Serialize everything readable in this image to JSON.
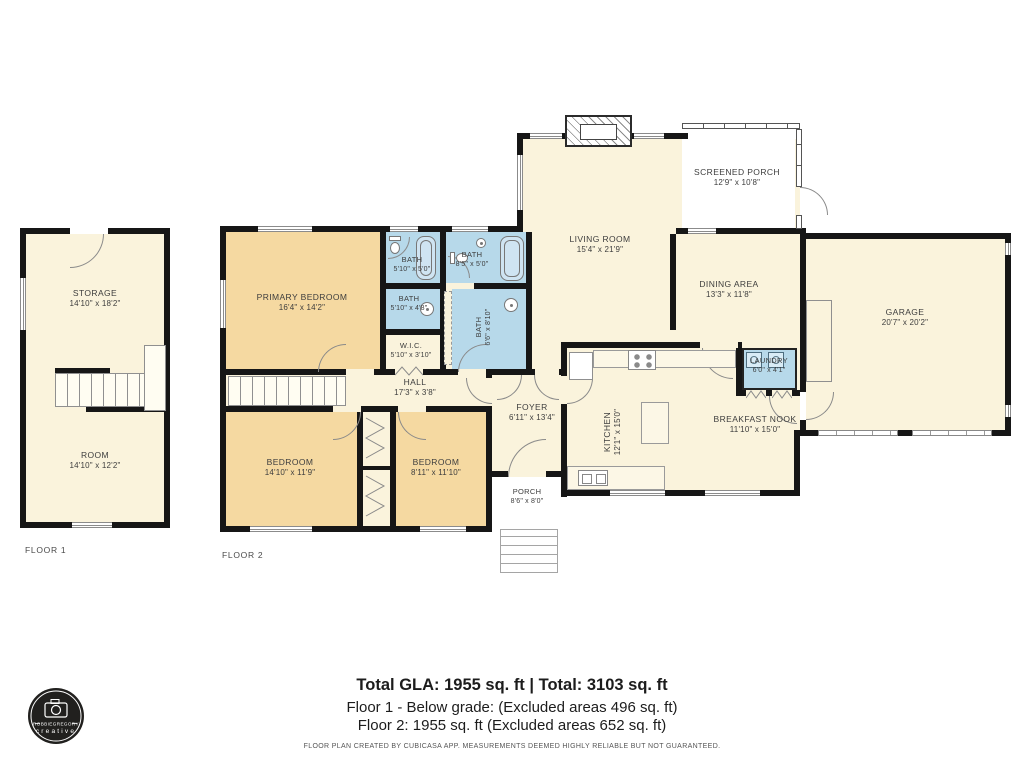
{
  "page": {
    "floor1_label": "FLOOR 1",
    "floor2_label": "FLOOR 2"
  },
  "rooms": {
    "storage": {
      "name": "STORAGE",
      "dims": "14'10\" x 18'2\""
    },
    "room": {
      "name": "ROOM",
      "dims": "14'10\" x 12'2\""
    },
    "primary_bedroom": {
      "name": "PRIMARY BEDROOM",
      "dims": "16'4\" x 14'2\""
    },
    "bath_a": {
      "name": "BATH",
      "dims": "5'10\" x 5'0\""
    },
    "bath_b": {
      "name": "BATH",
      "dims": "8'5\" x 5'0\""
    },
    "bath_c": {
      "name": "BATH",
      "dims": "5'10\" x 4'8\""
    },
    "bath_d": {
      "name": "BATH",
      "dims": "6'6\" x 8'10\""
    },
    "wic": {
      "name": "W.I.C.",
      "dims": "5'10\" x 3'10\""
    },
    "hall": {
      "name": "HALL",
      "dims": "17'3\" x 3'8\""
    },
    "living_room": {
      "name": "LIVING ROOM",
      "dims": "15'4\" x 21'9\""
    },
    "screened_porch": {
      "name": "SCREENED PORCH",
      "dims": "12'9\" x 10'8\""
    },
    "dining_area": {
      "name": "DINING AREA",
      "dims": "13'3\" x 11'8\""
    },
    "garage": {
      "name": "GARAGE",
      "dims": "20'7\" x 20'2\""
    },
    "laundry": {
      "name": "LAUNDRY",
      "dims": "6'0\" x 4'1\""
    },
    "kitchen": {
      "name": "KITCHEN",
      "dims": "12'1\" x 15'0\""
    },
    "breakfast_nook": {
      "name": "BREAKFAST NOOK",
      "dims": "11'10\" x 15'0\""
    },
    "foyer": {
      "name": "FOYER",
      "dims": "6'11\" x 13'4\""
    },
    "bedroom_left": {
      "name": "BEDROOM",
      "dims": "14'10\" x 11'9\""
    },
    "bedroom_right": {
      "name": "BEDROOM",
      "dims": "8'11\" x 11'10\""
    },
    "porch": {
      "name": "PORCH",
      "dims": "8'6\" x 8'0\""
    }
  },
  "footer": {
    "totals": "Total GLA: 1955 sq. ft | Total: 3103 sq. ft",
    "floor1_note": "Floor 1 - Below grade: (Excluded areas 496 sq. ft)",
    "floor2_note": "Floor 2: 1955 sq. ft (Excluded areas 652 sq. ft)",
    "disclaimer": "FLOOR PLAN CREATED BY CUBICASA APP. MEASUREMENTS DEEMED HIGHLY RELIABLE BUT NOT GUARANTEED."
  },
  "logo": {
    "brand": "ROBBIEGREGORY",
    "sub": "creative"
  },
  "colors": {
    "wall": "#161616",
    "room_cream": "#faf3dc",
    "room_tan": "#f5d9a1",
    "room_blue": "#b7d9ea",
    "background": "#ffffff"
  }
}
